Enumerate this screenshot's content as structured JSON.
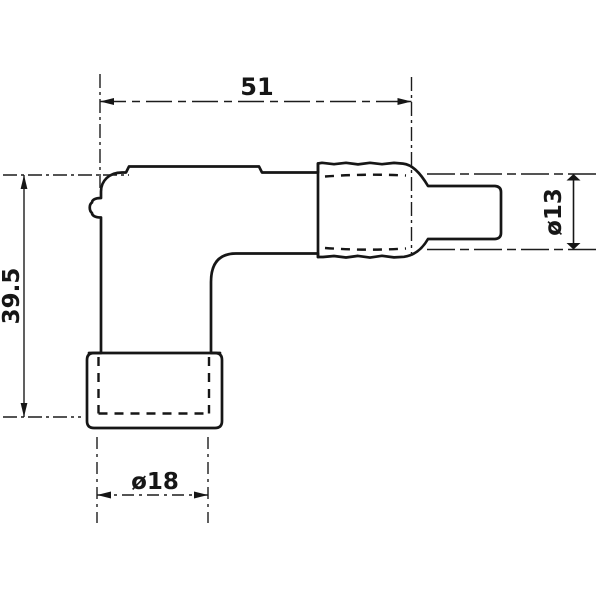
{
  "drawing": {
    "dimensions": {
      "width_mm": "51",
      "height_mm": "39.5",
      "boot_diameter": "ø13",
      "cap_diameter": "ø18"
    },
    "colors": {
      "line": "#1a1a1a",
      "background": "#ffffff"
    }
  }
}
